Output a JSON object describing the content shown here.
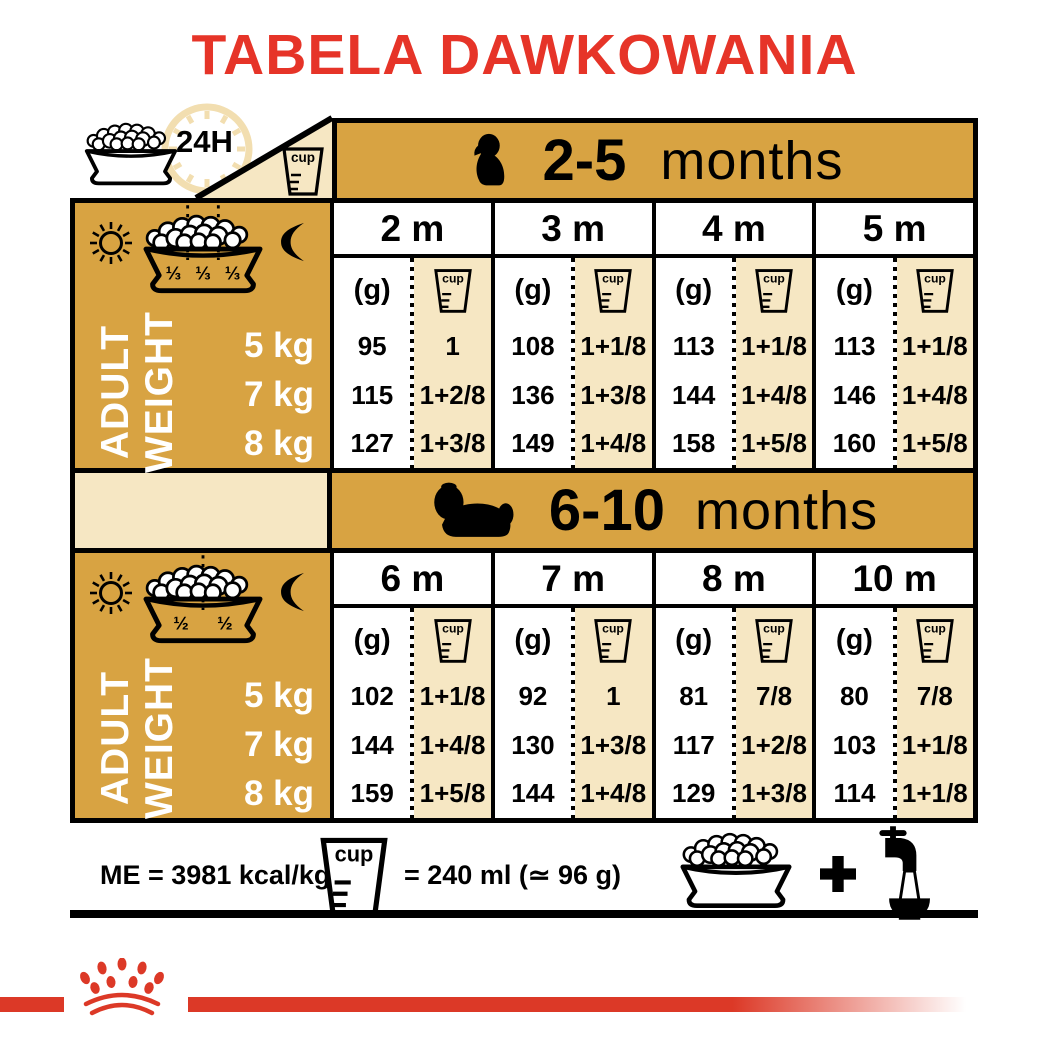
{
  "title": "TABELA DAWKOWANIA",
  "labels": {
    "clock": "24H",
    "cup": "cup",
    "g": "(g)"
  },
  "sections": [
    {
      "age": "2-5",
      "age_unit": "months",
      "columns": [
        "2 m",
        "3 m",
        "4 m",
        "5 m"
      ],
      "bowl_fractions": [
        "⅓",
        "⅓",
        "⅓"
      ],
      "side_label_line1": "ADULT",
      "side_label_line2": "WEIGHT",
      "weights": [
        "5 kg",
        "7 kg",
        "8 kg"
      ],
      "rows": [
        {
          "cells": [
            {
              "g": "95",
              "cup": "1"
            },
            {
              "g": "108",
              "cup": "1+1/8"
            },
            {
              "g": "113",
              "cup": "1+1/8"
            },
            {
              "g": "113",
              "cup": "1+1/8"
            }
          ]
        },
        {
          "cells": [
            {
              "g": "115",
              "cup": "1+2/8"
            },
            {
              "g": "136",
              "cup": "1+3/8"
            },
            {
              "g": "144",
              "cup": "1+4/8"
            },
            {
              "g": "146",
              "cup": "1+4/8"
            }
          ]
        },
        {
          "cells": [
            {
              "g": "127",
              "cup": "1+3/8"
            },
            {
              "g": "149",
              "cup": "1+4/8"
            },
            {
              "g": "158",
              "cup": "1+5/8"
            },
            {
              "g": "160",
              "cup": "1+5/8"
            }
          ]
        }
      ]
    },
    {
      "age": "6-10",
      "age_unit": "months",
      "columns": [
        "6 m",
        "7 m",
        "8 m",
        "10 m"
      ],
      "bowl_fractions": [
        "½",
        "½"
      ],
      "side_label_line1": "ADULT",
      "side_label_line2": "WEIGHT",
      "weights": [
        "5 kg",
        "7 kg",
        "8 kg"
      ],
      "rows": [
        {
          "cells": [
            {
              "g": "102",
              "cup": "1+1/8"
            },
            {
              "g": "92",
              "cup": "1"
            },
            {
              "g": "81",
              "cup": "7/8"
            },
            {
              "g": "80",
              "cup": "7/8"
            }
          ]
        },
        {
          "cells": [
            {
              "g": "144",
              "cup": "1+4/8"
            },
            {
              "g": "130",
              "cup": "1+3/8"
            },
            {
              "g": "117",
              "cup": "1+2/8"
            },
            {
              "g": "103",
              "cup": "1+1/8"
            }
          ]
        },
        {
          "cells": [
            {
              "g": "159",
              "cup": "1+5/8"
            },
            {
              "g": "144",
              "cup": "1+4/8"
            },
            {
              "g": "129",
              "cup": "1+3/8"
            },
            {
              "g": "114",
              "cup": "1+1/8"
            }
          ]
        }
      ]
    }
  ],
  "footer": {
    "me": "ME = 3981 kcal/kg",
    "cup_equiv": "= 240 ml (≃ 96 g)"
  },
  "colors": {
    "gold": "#D8A342",
    "cream": "#F6E7C3",
    "title_red": "#E63428",
    "band_red": "#DC3927"
  }
}
